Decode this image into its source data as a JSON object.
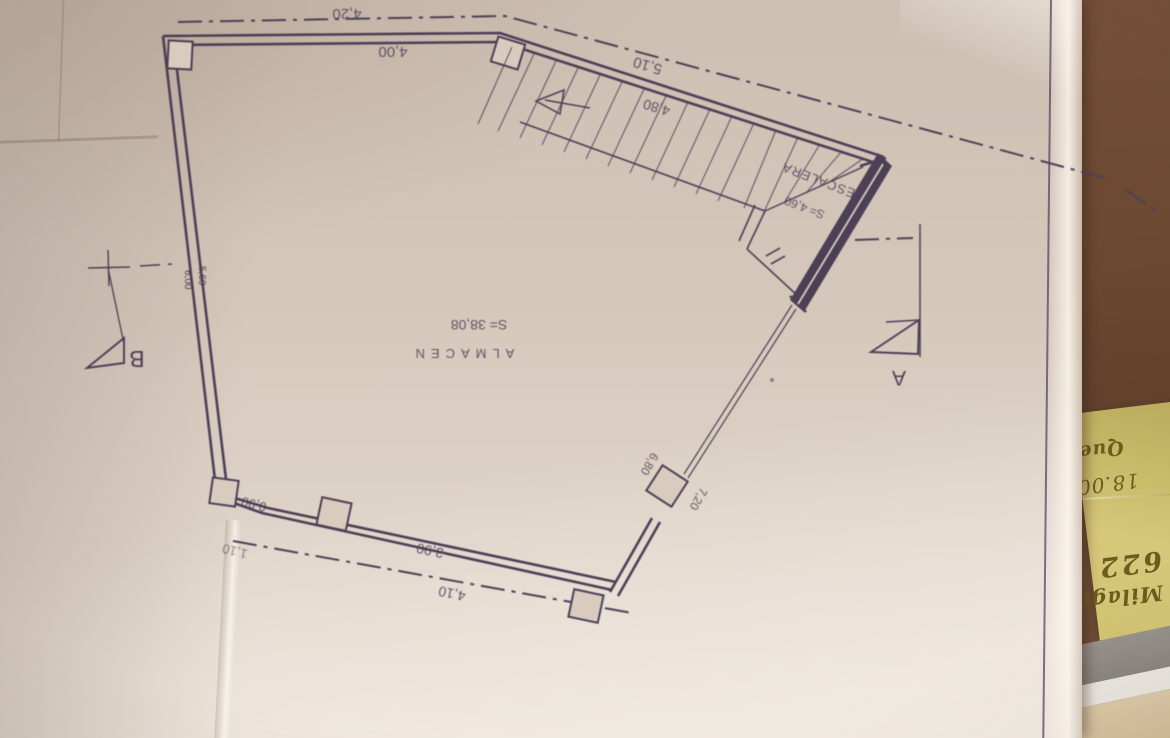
{
  "plan": {
    "room": {
      "name": "ALMACEN",
      "area": "S= 38,08"
    },
    "stair": {
      "label": "ESCALERA",
      "area": "S= 4,60",
      "width": "4,80",
      "outer": "5,10"
    },
    "dimensions": {
      "top_outer": "4,20",
      "top_inner": "4,00",
      "bottom_corner": "0,90",
      "bottom_corner_outer": "1,10",
      "bottom_inner": "3,90",
      "bottom_outer": "4,10",
      "front_upper": "6,80",
      "front_lower": "7,20"
    },
    "sections": {
      "a": "A",
      "b": "B"
    },
    "pencil_notes": {
      "n1": "6,00",
      "n2": "5,60"
    },
    "ink_color": "#4c3f56"
  },
  "sticky_note": {
    "lines": {
      "l1": "Milagr",
      "l2": "622",
      "l3": "18.00",
      "l4": "Que"
    },
    "paper_color": "#d0c170",
    "ink_color": "#6d5c1d"
  },
  "colors": {
    "desk": "#6b4832",
    "plan_paper": "#d5c8bb",
    "second_note": "#c08a38",
    "stack_gray": "#8f8a85",
    "stack_white": "#eae6e0",
    "stack_tan": "#d8c5a3"
  }
}
